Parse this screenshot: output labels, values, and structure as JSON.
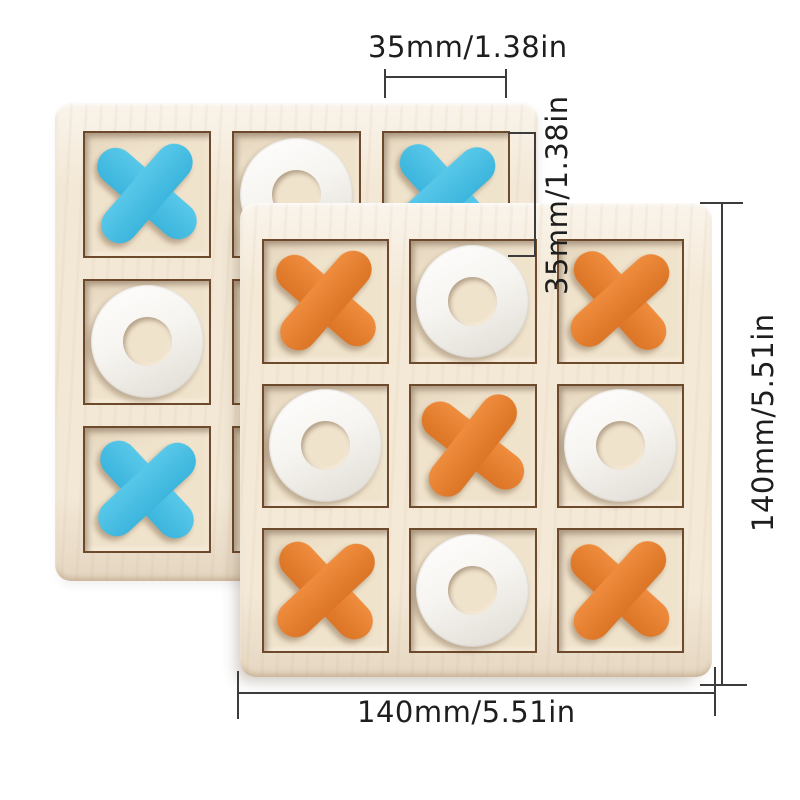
{
  "image": {
    "kind": "product-dimension-photo",
    "subject": "wooden tic-tac-toe (XO) board game, two boards stacked",
    "background_color": "#ffffff"
  },
  "annotations": {
    "piece_width": "35mm/1.38in",
    "piece_height": "35mm/1.38in",
    "board_height": "140mm/5.51in",
    "board_width": "140mm/5.51in",
    "line_color": "#3c3c3c",
    "text_color": "#1e1e1e"
  },
  "boards": {
    "back": {
      "label": "back board with blue X and white O pieces",
      "grid": [
        [
          "X",
          "O",
          "X"
        ],
        [
          "O",
          "",
          ""
        ],
        [
          "X",
          "",
          ""
        ]
      ],
      "x_color": "#58c8e9",
      "x_color_dark": "#3cb5dd",
      "o_color": "#f7f5f1",
      "wood_color": "#f3e8d6",
      "cell_color": "#f0e3cc"
    },
    "front": {
      "label": "front board with orange X and white O pieces",
      "grid": [
        [
          "X",
          "O",
          "X"
        ],
        [
          "O",
          "X",
          "O"
        ],
        [
          "X",
          "O",
          "X"
        ]
      ],
      "x_color": "#ef8c3d",
      "x_color_dark": "#dc7526",
      "o_color": "#f7f5f1",
      "wood_color": "#f4e9d7",
      "cell_color": "#f0e3cc"
    }
  }
}
